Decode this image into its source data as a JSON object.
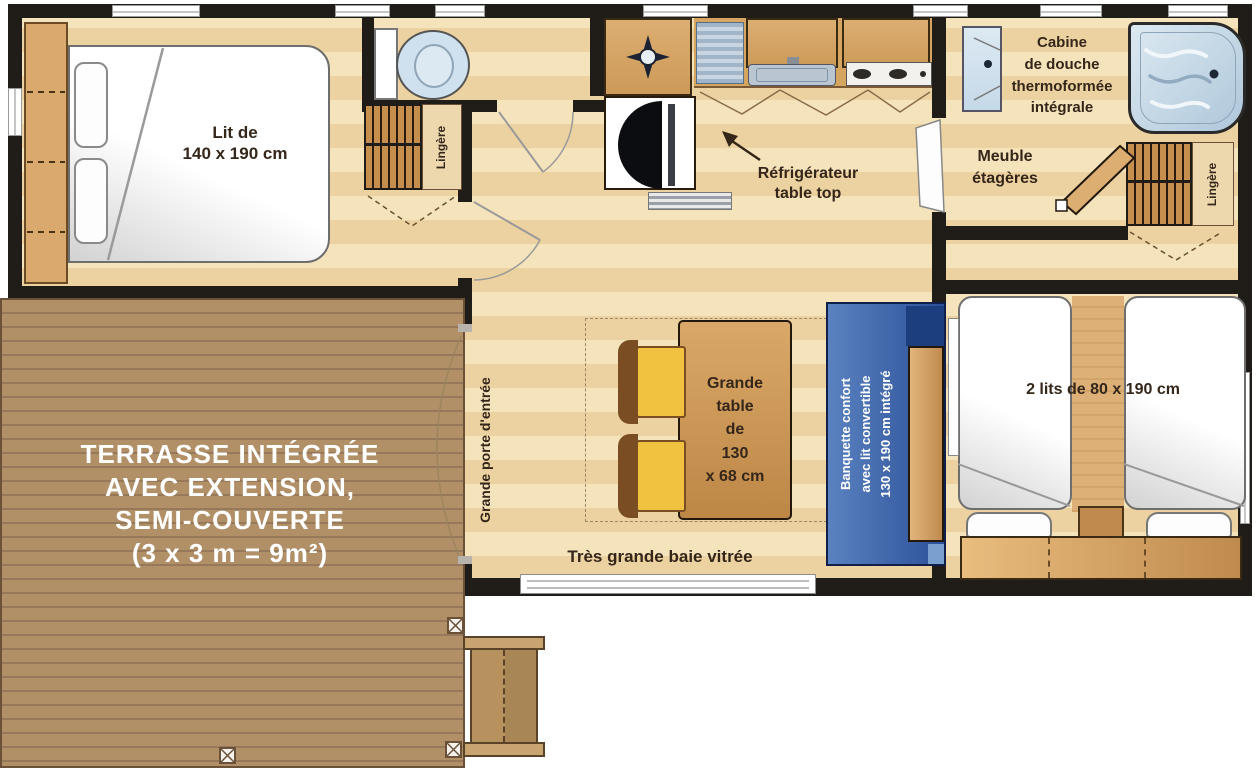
{
  "colors": {
    "wall": "#201c17",
    "floor_light": "#f5e3bb",
    "floor_mid": "#ecd2a0",
    "deck": "#b29067",
    "deck_line": "#96795a",
    "cabinet_wood": "#cd9a58",
    "water_blue": "#c6d9e8",
    "banquette_blue": "#3c67ad",
    "banquette_dark": "#1c3d7e",
    "chair_yellow": "#f0c240",
    "ink": "#35261a",
    "terrace_text": "#ffffff"
  },
  "labels": {
    "master_bed_line1": "Lit de",
    "master_bed_line2": "140 x 190 cm",
    "lingere_left": "Lingère",
    "lingere_right": "Lingère",
    "fridge_line1": "Réfrigérateur",
    "fridge_line2": "table top",
    "shower_line1": "Cabine",
    "shower_line2": "de douche",
    "shower_line3": "thermoformée",
    "shower_line4": "intégrale",
    "shelf_line1": "Meuble",
    "shelf_line2": "étagères",
    "twin_beds": "2 lits de 80 x 190 cm",
    "table_line1": "Grande",
    "table_line2": "table",
    "table_line3": "de",
    "table_line4": "130",
    "table_line5": "x 68 cm",
    "banquette_line1": "Banquette confort",
    "banquette_line2": "avec lit convertible",
    "banquette_line3": "130 x 190 cm intégré",
    "bay_window": "Très grande baie vitrée",
    "entrance_door": "Grande porte d'entrée",
    "terrace_line1": "TERRASSE INTÉGRÉE",
    "terrace_line2": "AVEC EXTENSION,",
    "terrace_line3": "SEMI-COUVERTE",
    "terrace_line4": "(3 x 3 m = 9m²)"
  }
}
